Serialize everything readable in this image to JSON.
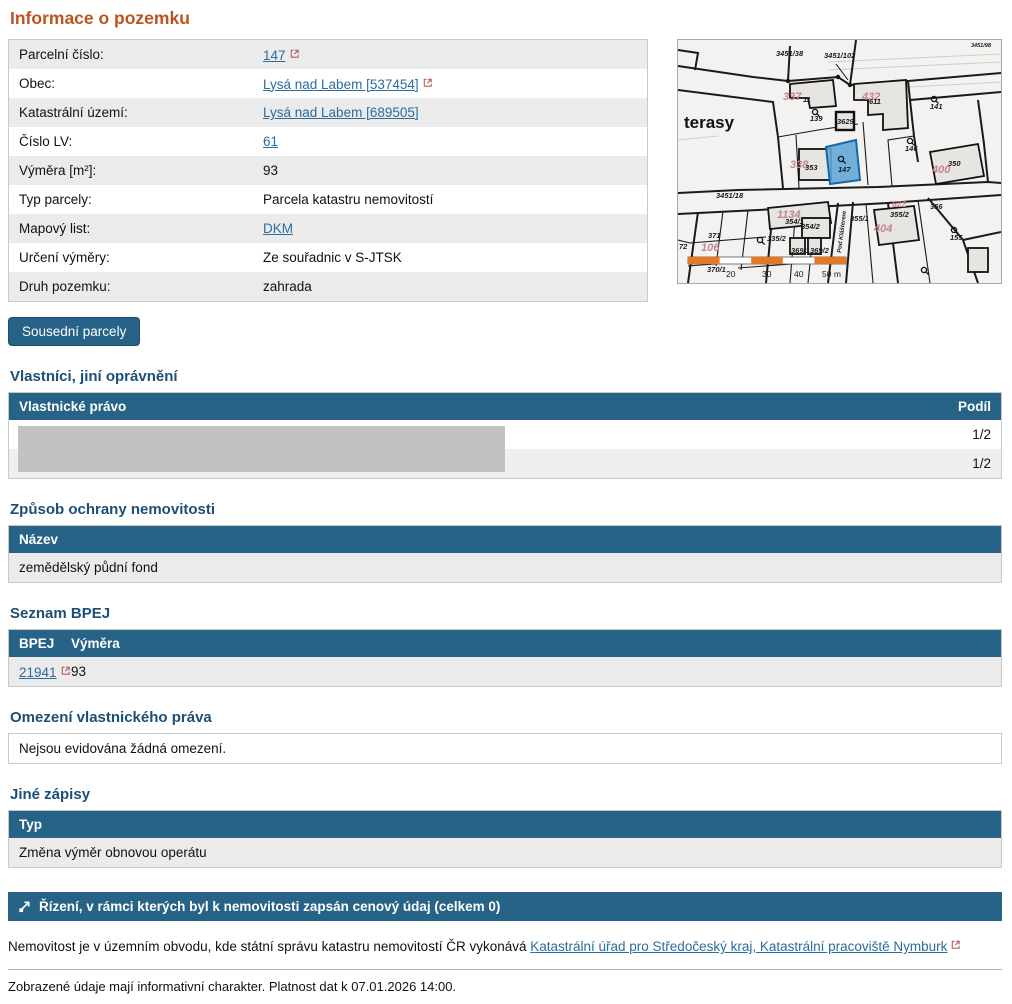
{
  "page": {
    "title": "Informace o pozemku"
  },
  "colors": {
    "accent_orange": "#bd541f",
    "table_header_blue": "#266386",
    "heading_blue": "#1d4f76",
    "link_blue": "#2a6d9e",
    "external_icon_red": "#b35f63",
    "highlight_parcel_blue": "#64a8d8",
    "scale_bar_orange": "#e87722",
    "redaction_gray": "#c2c2c2"
  },
  "info": {
    "rows": [
      {
        "label": "Parcelní číslo:",
        "value": "147"
      },
      {
        "label": "Obec:",
        "value": "Lysá nad Labem [537454]"
      },
      {
        "label": "Katastrální území:",
        "value": "Lysá nad Labem [689505]"
      },
      {
        "label": "Číslo LV:",
        "value": "61"
      },
      {
        "label": "Výměra [m²]:",
        "value": "93"
      },
      {
        "label": "Typ parcely:",
        "value": "Parcela katastru nemovitostí"
      },
      {
        "label": "Mapový list:",
        "value": "DKM"
      },
      {
        "label": "Určení výměry:",
        "value": "Ze souřadnic v S-JTSK"
      },
      {
        "label": "Druh pozemku:",
        "value": "zahrada"
      }
    ]
  },
  "buttons": {
    "neighbors": "Sousední parcely"
  },
  "owners": {
    "heading": "Vlastníci, jiní oprávnění",
    "col_left": "Vlastnické právo",
    "col_right": "Podíl",
    "rows": [
      {
        "share": "1/2"
      },
      {
        "share": "1/2"
      }
    ]
  },
  "protection": {
    "heading": "Způsob ochrany nemovitosti",
    "col": "Název",
    "row": "zemědělský půdní fond"
  },
  "bpej": {
    "heading": "Seznam BPEJ",
    "col1": "BPEJ",
    "col2": "Výměra",
    "row": {
      "code": "21941",
      "area": "93"
    }
  },
  "restrictions": {
    "heading": "Omezení vlastnického práva",
    "text": "Nejsou evidována žádná omezení."
  },
  "other": {
    "heading": "Jiné zápisy",
    "col": "Typ",
    "row": "Změna výměr obnovou operátu"
  },
  "proceedings": {
    "label": "Řízení, v rámci kterých byl k nemovitosti zapsán cenový údaj (celkem 0)"
  },
  "footer": {
    "text_before_link": "Nemovitost je v územním obvodu, kde státní správu katastru nemovitostí ČR vykonává ",
    "link": "Katastrální úřad pro Středočeský kraj, Katastrální pracoviště Nymburk",
    "disclaimer": "Zobrazené údaje mají informativní charakter. Platnost dat k 07.01.2026 14:00."
  },
  "map": {
    "highlighted_parcel": "147",
    "labels": [
      {
        "t": "3451/38",
        "x": 98,
        "y": 16
      },
      {
        "t": "3451/102",
        "x": 146,
        "y": 18
      },
      {
        "t": "3451/98",
        "x": 293,
        "y": 7,
        "c": "tiny"
      },
      {
        "t": "terasy",
        "x": 6,
        "y": 88,
        "c": "lg"
      },
      {
        "t": "337",
        "x": 105,
        "y": 60,
        "c": "pink"
      },
      {
        "t": "11",
        "x": 125,
        "y": 62
      },
      {
        "t": "139",
        "x": 132,
        "y": 81
      },
      {
        "t": "3629",
        "x": 159,
        "y": 84
      },
      {
        "t": "432",
        "x": 184,
        "y": 60,
        "c": "pink"
      },
      {
        "t": "611",
        "x": 191,
        "y": 64
      },
      {
        "t": "141",
        "x": 252,
        "y": 69
      },
      {
        "t": "146",
        "x": 227,
        "y": 111
      },
      {
        "t": "338",
        "x": 112,
        "y": 128,
        "c": "pink"
      },
      {
        "t": "353",
        "x": 127,
        "y": 130
      },
      {
        "t": "147",
        "x": 160,
        "y": 132
      },
      {
        "t": "400",
        "x": 254,
        "y": 133,
        "c": "pink"
      },
      {
        "t": "350",
        "x": 270,
        "y": 126
      },
      {
        "t": "3451/18",
        "x": 38,
        "y": 158
      },
      {
        "t": "622",
        "x": 214,
        "y": 167,
        "c": "pink2"
      },
      {
        "t": "1134",
        "x": 99,
        "y": 178,
        "c": "pink"
      },
      {
        "t": "354/1",
        "x": 107,
        "y": 184
      },
      {
        "t": "354/2",
        "x": 123,
        "y": 189
      },
      {
        "t": "355/1",
        "x": 172,
        "y": 181
      },
      {
        "t": "355/2",
        "x": 212,
        "y": 177
      },
      {
        "t": "356",
        "x": 252,
        "y": 169
      },
      {
        "t": "404",
        "x": 196,
        "y": 192,
        "c": "pink"
      },
      {
        "t": "371",
        "x": 30,
        "y": 198
      },
      {
        "t": "106",
        "x": 23,
        "y": 211,
        "c": "pink"
      },
      {
        "t": "72",
        "x": 1,
        "y": 209
      },
      {
        "t": "135/2",
        "x": 89,
        "y": 201
      },
      {
        "t": "369/1",
        "x": 113,
        "y": 213
      },
      {
        "t": "369/2",
        "x": 132,
        "y": 213
      },
      {
        "t": "155",
        "x": 272,
        "y": 200
      },
      {
        "t": "370/1",
        "x": 29,
        "y": 232
      },
      {
        "t": "Pod Klášterem",
        "x": 163,
        "y": 213,
        "c": "street",
        "r": -83
      },
      {
        "t": "20",
        "x": 48,
        "y": 237,
        "c": "scale"
      },
      {
        "t": "30",
        "x": 84,
        "y": 237,
        "c": "scale"
      },
      {
        "t": "40",
        "x": 116,
        "y": 237,
        "c": "scale"
      },
      {
        "t": "50 m",
        "x": 144,
        "y": 237,
        "c": "scale"
      }
    ]
  }
}
